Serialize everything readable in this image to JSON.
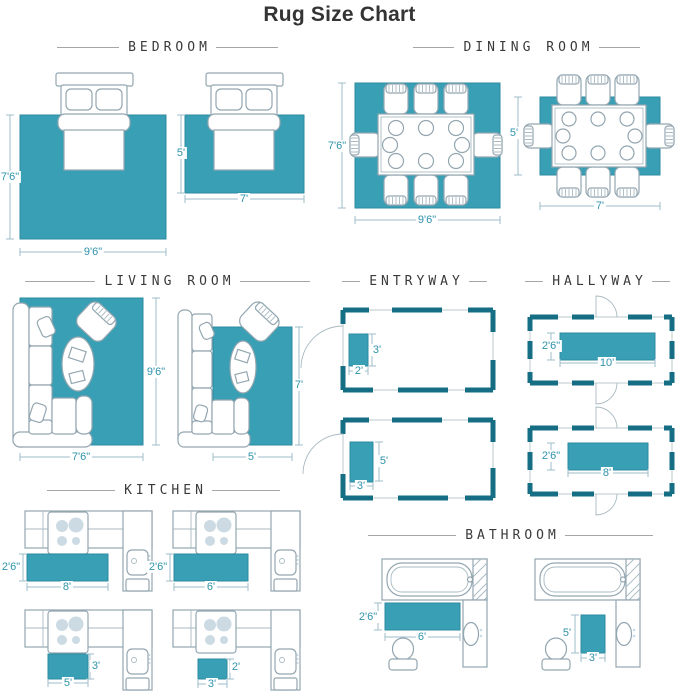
{
  "title": "Rug Size Chart",
  "sections": {
    "bedroom": {
      "title": "BEDROOM",
      "rugs": [
        {
          "w": "9'6\"",
          "h": "7'6\""
        },
        {
          "w": "7'",
          "h": "5'"
        }
      ]
    },
    "dining_room": {
      "title": "DINING ROOM",
      "rugs": [
        {
          "w": "9'6\"",
          "h": "7'6\""
        },
        {
          "w": "7'",
          "h": "5'"
        }
      ]
    },
    "living_room": {
      "title": "LIVING ROOM",
      "rugs": [
        {
          "w": "7'6\"",
          "h": "9'6\""
        },
        {
          "w": "5'",
          "h": "7'"
        }
      ]
    },
    "entryway": {
      "title": "ENTRYWAY",
      "rugs": [
        {
          "w": "2'",
          "h": "3'"
        },
        {
          "w": "3'",
          "h": "5'"
        }
      ]
    },
    "hallway": {
      "title": "HALLYWAY",
      "rugs": [
        {
          "w": "10'",
          "h": "2'6\""
        },
        {
          "w": "8'",
          "h": "2'6\""
        }
      ]
    },
    "kitchen": {
      "title": "KITCHEN",
      "rugs": [
        {
          "w": "8'",
          "h": "2'6\""
        },
        {
          "w": "6'",
          "h": "2'6\""
        },
        {
          "w": "5'",
          "h": "3'"
        },
        {
          "w": "3'",
          "h": "2'"
        }
      ]
    },
    "bathroom": {
      "title": "BATHROOM",
      "rugs": [
        {
          "w": "6'",
          "h": "2'6\""
        },
        {
          "w": "3'",
          "h": "5'"
        }
      ]
    }
  },
  "colors": {
    "rug": "#389FB5",
    "wall": "#156E83",
    "outline": "#93A6B0",
    "dimension": "#2F93AB"
  }
}
